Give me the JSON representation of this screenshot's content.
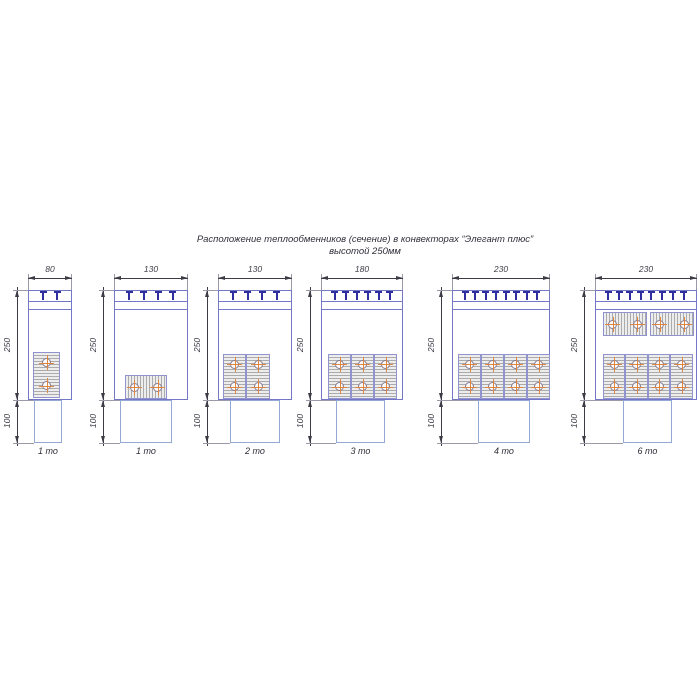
{
  "title": {
    "line1": "Расположение теплообменников (сечение) в конвекторах “Элегант плюс”",
    "line2": "высотой 250мм"
  },
  "colors": {
    "line_blue": "#7476c6",
    "clip_navy": "#2e2e9e",
    "dimension": "#3c3c46",
    "extension": "#9a9aa8",
    "hatch_bg": "#ededed",
    "hatch_line": "#ababab",
    "block_border": "#9093cd",
    "tube_ring": "#897b94",
    "tube_cross": "#e0873f",
    "duct_blue": "#93a9d4",
    "text_dark": "#2f2f3a"
  },
  "layout": {
    "ext_top": 274,
    "dim_line_y": 278,
    "dim_text_y": 264,
    "body_top": 290,
    "grille_mid": 301,
    "grille_low": 309,
    "body_bottom": 400,
    "duct_bottom": 443,
    "label_y": 446,
    "dim_offset": 11
  },
  "convectors": [
    {
      "width_label": "80",
      "height_label": "250",
      "duct_height_label": "100",
      "label": "1 то",
      "clips": 2,
      "x": 28,
      "body_w": 44,
      "duct": {
        "x": 34,
        "w": 28
      },
      "blocks": [
        {
          "o": "v",
          "x": 33,
          "y": 352,
          "w": 27,
          "h": 46
        }
      ]
    },
    {
      "width_label": "130",
      "height_label": "250",
      "duct_height_label": "100",
      "label": "1 то",
      "clips": 4,
      "x": 114,
      "body_w": 74,
      "duct": {
        "x": 120,
        "w": 52
      },
      "blocks": [
        {
          "o": "h",
          "x": 125,
          "y": 375,
          "w": 42,
          "h": 24
        }
      ]
    },
    {
      "width_label": "130",
      "height_label": "250",
      "duct_height_label": "100",
      "label": "2 то",
      "clips": 4,
      "x": 218,
      "body_w": 74,
      "duct": {
        "x": 230,
        "w": 50
      },
      "blocks": [
        {
          "o": "v",
          "x": 223,
          "y": 354,
          "w": 23,
          "h": 45
        },
        {
          "o": "v",
          "x": 246,
          "y": 354,
          "w": 24,
          "h": 45
        }
      ]
    },
    {
      "width_label": "180",
      "height_label": "250",
      "duct_height_label": "100",
      "label": "3 то",
      "clips": 6,
      "x": 321,
      "body_w": 82,
      "duct": {
        "x": 336,
        "w": 49
      },
      "blocks": [
        {
          "o": "v",
          "x": 328,
          "y": 354,
          "w": 23,
          "h": 45
        },
        {
          "o": "v",
          "x": 351,
          "y": 354,
          "w": 23,
          "h": 45
        },
        {
          "o": "v",
          "x": 374,
          "y": 354,
          "w": 23,
          "h": 45
        }
      ]
    },
    {
      "width_label": "230",
      "height_label": "250",
      "duct_height_label": "100",
      "label": "4 то",
      "clips": 8,
      "x": 452,
      "body_w": 98,
      "duct": {
        "x": 478,
        "w": 52
      },
      "blocks": [
        {
          "o": "v",
          "x": 458,
          "y": 354,
          "w": 23,
          "h": 45
        },
        {
          "o": "v",
          "x": 481,
          "y": 354,
          "w": 23,
          "h": 45
        },
        {
          "o": "v",
          "x": 504,
          "y": 354,
          "w": 23,
          "h": 45
        },
        {
          "o": "v",
          "x": 527,
          "y": 354,
          "w": 23,
          "h": 45
        }
      ]
    },
    {
      "width_label": "230",
      "height_label": "250",
      "duct_height_label": "100",
      "label": "6 то",
      "clips": 8,
      "x": 595,
      "body_w": 102,
      "duct": {
        "x": 623,
        "w": 49
      },
      "blocks": [
        {
          "o": "h",
          "x": 603,
          "y": 312,
          "w": 44,
          "h": 24
        },
        {
          "o": "h",
          "x": 650,
          "y": 312,
          "w": 44,
          "h": 24
        },
        {
          "o": "v",
          "x": 603,
          "y": 354,
          "w": 22,
          "h": 45
        },
        {
          "o": "v",
          "x": 625,
          "y": 354,
          "w": 23,
          "h": 45
        },
        {
          "o": "v",
          "x": 648,
          "y": 354,
          "w": 22,
          "h": 45
        },
        {
          "o": "v",
          "x": 670,
          "y": 354,
          "w": 23,
          "h": 45
        }
      ]
    }
  ]
}
